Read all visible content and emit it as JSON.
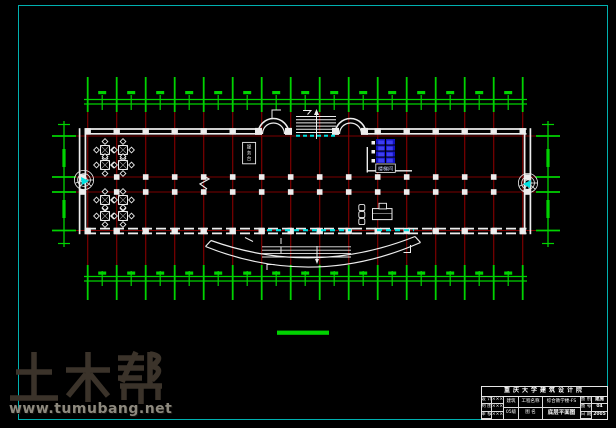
{
  "colors": {
    "green": "#00d300",
    "red": "#7d0000",
    "wall": "#ededed",
    "cyan": "#00e0e0",
    "blue": "#1111c0",
    "blue_light": "#3d3df2",
    "frame": "#00b0b0",
    "wm_logo": "#3b332a",
    "wm_url": "#8d897e"
  },
  "watermark": {
    "logo": "土木帮",
    "url": "www.tumubang.net"
  },
  "plan": {
    "grid": {
      "x0": 87.7,
      "dx": 29,
      "count": 16,
      "v_y1": 107,
      "v_y2": 267,
      "rows": [
        136,
        177,
        192,
        230.5
      ],
      "h_x1": 76,
      "h_x2": 536
    },
    "dims": {
      "top": {
        "y_lines": [
          99.5,
          104
        ],
        "x1": 84,
        "x2": 527,
        "tick_y": [
          77,
          112
        ],
        "mid_y": [
          95,
          110
        ],
        "blob_y": 91
      },
      "bottom": {
        "y_lines": [
          276.5,
          281
        ],
        "x1": 84,
        "x2": 527,
        "tick_y": [
          265,
          300
        ],
        "mid_y": [
          271,
          286
        ],
        "blob_y": 271.5
      },
      "left": {
        "x": 64,
        "y1": 121,
        "y2": 247,
        "tick_x": [
          52,
          76
        ]
      },
      "right": {
        "x": 548,
        "y1": 121,
        "y2": 247,
        "tick_x": [
          536,
          560
        ]
      }
    },
    "walls": {
      "top_y": [
        129,
        133.8
      ],
      "top_segments": [
        [
          86,
          259
        ],
        [
          366,
          526.5
        ]
      ],
      "bottom_y": [
        228.6,
        233.4
      ],
      "bottom_x": [
        86,
        526.5
      ],
      "left_x": [
        79.6,
        85.4
      ],
      "right_x": [
        524.6,
        530.4
      ],
      "wall_y": [
        128.2,
        234.2
      ]
    },
    "top_skip_k": [
      6,
      7,
      8,
      9
    ],
    "mid_cols_k": [
      1,
      2,
      3,
      4,
      5,
      6,
      7,
      8,
      9,
      10,
      11,
      12,
      13,
      14
    ],
    "arc_pads_x": [
      258.5,
      288.5,
      335.5,
      364.5
    ],
    "tables": [
      [
        105,
        150
      ],
      [
        123,
        150
      ],
      [
        105,
        165
      ],
      [
        123,
        165
      ],
      [
        105,
        200
      ],
      [
        123,
        200
      ],
      [
        105,
        216
      ],
      [
        123,
        216
      ]
    ],
    "labels": {
      "stair_room": "楼梯间",
      "service_desk": "服务台"
    },
    "scale_bar": {
      "x": 277,
      "y": 330.6,
      "w": 52,
      "h": 4.2
    }
  },
  "title_block": {
    "header": "重庆大学建筑设计院",
    "left_rows": [
      [
        "设 计",
        "×××"
      ],
      [
        "制 图",
        "×××"
      ],
      [
        "审 核",
        "×××"
      ]
    ],
    "col3": [
      "建筑",
      "05级"
    ],
    "col4": [
      "工程名称",
      "图 名"
    ],
    "col5": [
      "综合教学楼-FS",
      "底层平面图"
    ],
    "right_rows": [
      [
        "图 别",
        "建施"
      ],
      [
        "图 号",
        "04"
      ],
      [
        "日 期",
        "2005"
      ]
    ]
  }
}
